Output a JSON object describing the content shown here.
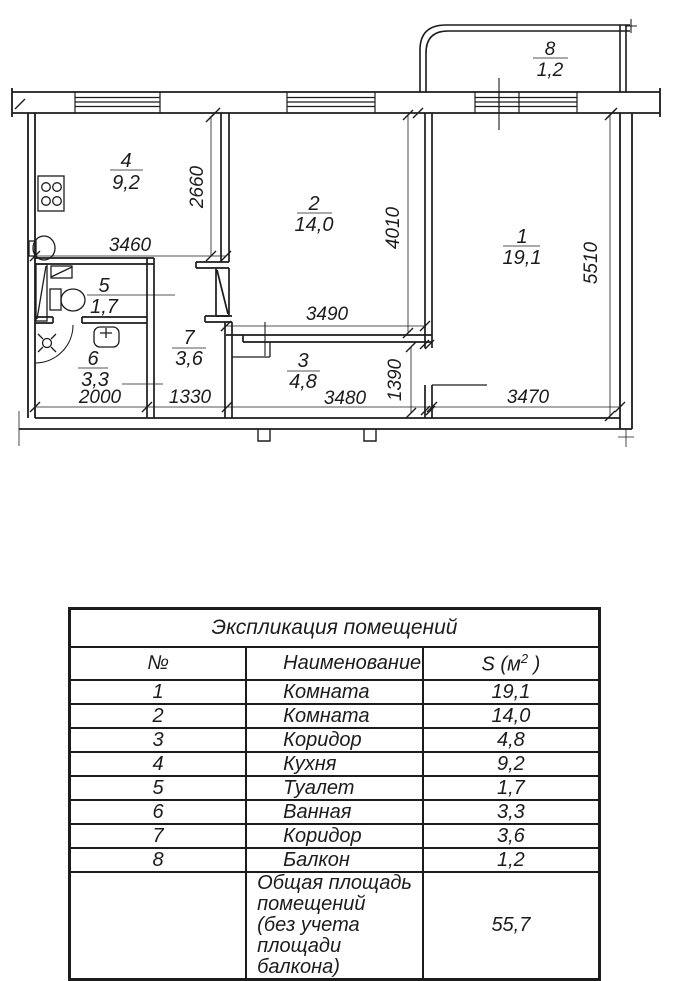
{
  "plan": {
    "rooms": {
      "r1": {
        "num": "1",
        "area": "19,1"
      },
      "r2": {
        "num": "2",
        "area": "14,0"
      },
      "r3": {
        "num": "3",
        "area": "4,8"
      },
      "r4": {
        "num": "4",
        "area": "9,2"
      },
      "r5": {
        "num": "5",
        "area": "1,7"
      },
      "r6": {
        "num": "6",
        "area": "3,3"
      },
      "r7": {
        "num": "7",
        "area": "3,6"
      },
      "r8": {
        "num": "8",
        "area": "1,2"
      }
    },
    "dims": {
      "d3460": "3460",
      "d2660": "2660",
      "d4010": "4010",
      "d5510": "5510",
      "d3490": "3490",
      "d1390": "1390",
      "d2000": "2000",
      "d1330": "1330",
      "d3480": "3480",
      "d3470": "3470"
    },
    "line_color": "#1c1c1c"
  },
  "table": {
    "title": "Экспликация помещений",
    "col_num": "№",
    "col_name": "Наименование",
    "col_area_pre": "S (м",
    "col_area_sup": "2",
    "col_area_post": " )",
    "rows": [
      {
        "num": "1",
        "name": "Комната",
        "area": "19,1"
      },
      {
        "num": "2",
        "name": "Комната",
        "area": "14,0"
      },
      {
        "num": "3",
        "name": "Коридор",
        "area": "4,8"
      },
      {
        "num": "4",
        "name": "Кухня",
        "area": "9,2"
      },
      {
        "num": "5",
        "name": "Туалет",
        "area": "1,7"
      },
      {
        "num": "6",
        "name": "Ванная",
        "area": "3,3"
      },
      {
        "num": "7",
        "name": "Коридор",
        "area": "3,6"
      },
      {
        "num": "8",
        "name": "Балкон",
        "area": "1,2"
      }
    ],
    "total_line1": "Общая площадь помещений",
    "total_line2": "(без учета площади балкона)",
    "total_area": "55,7"
  }
}
